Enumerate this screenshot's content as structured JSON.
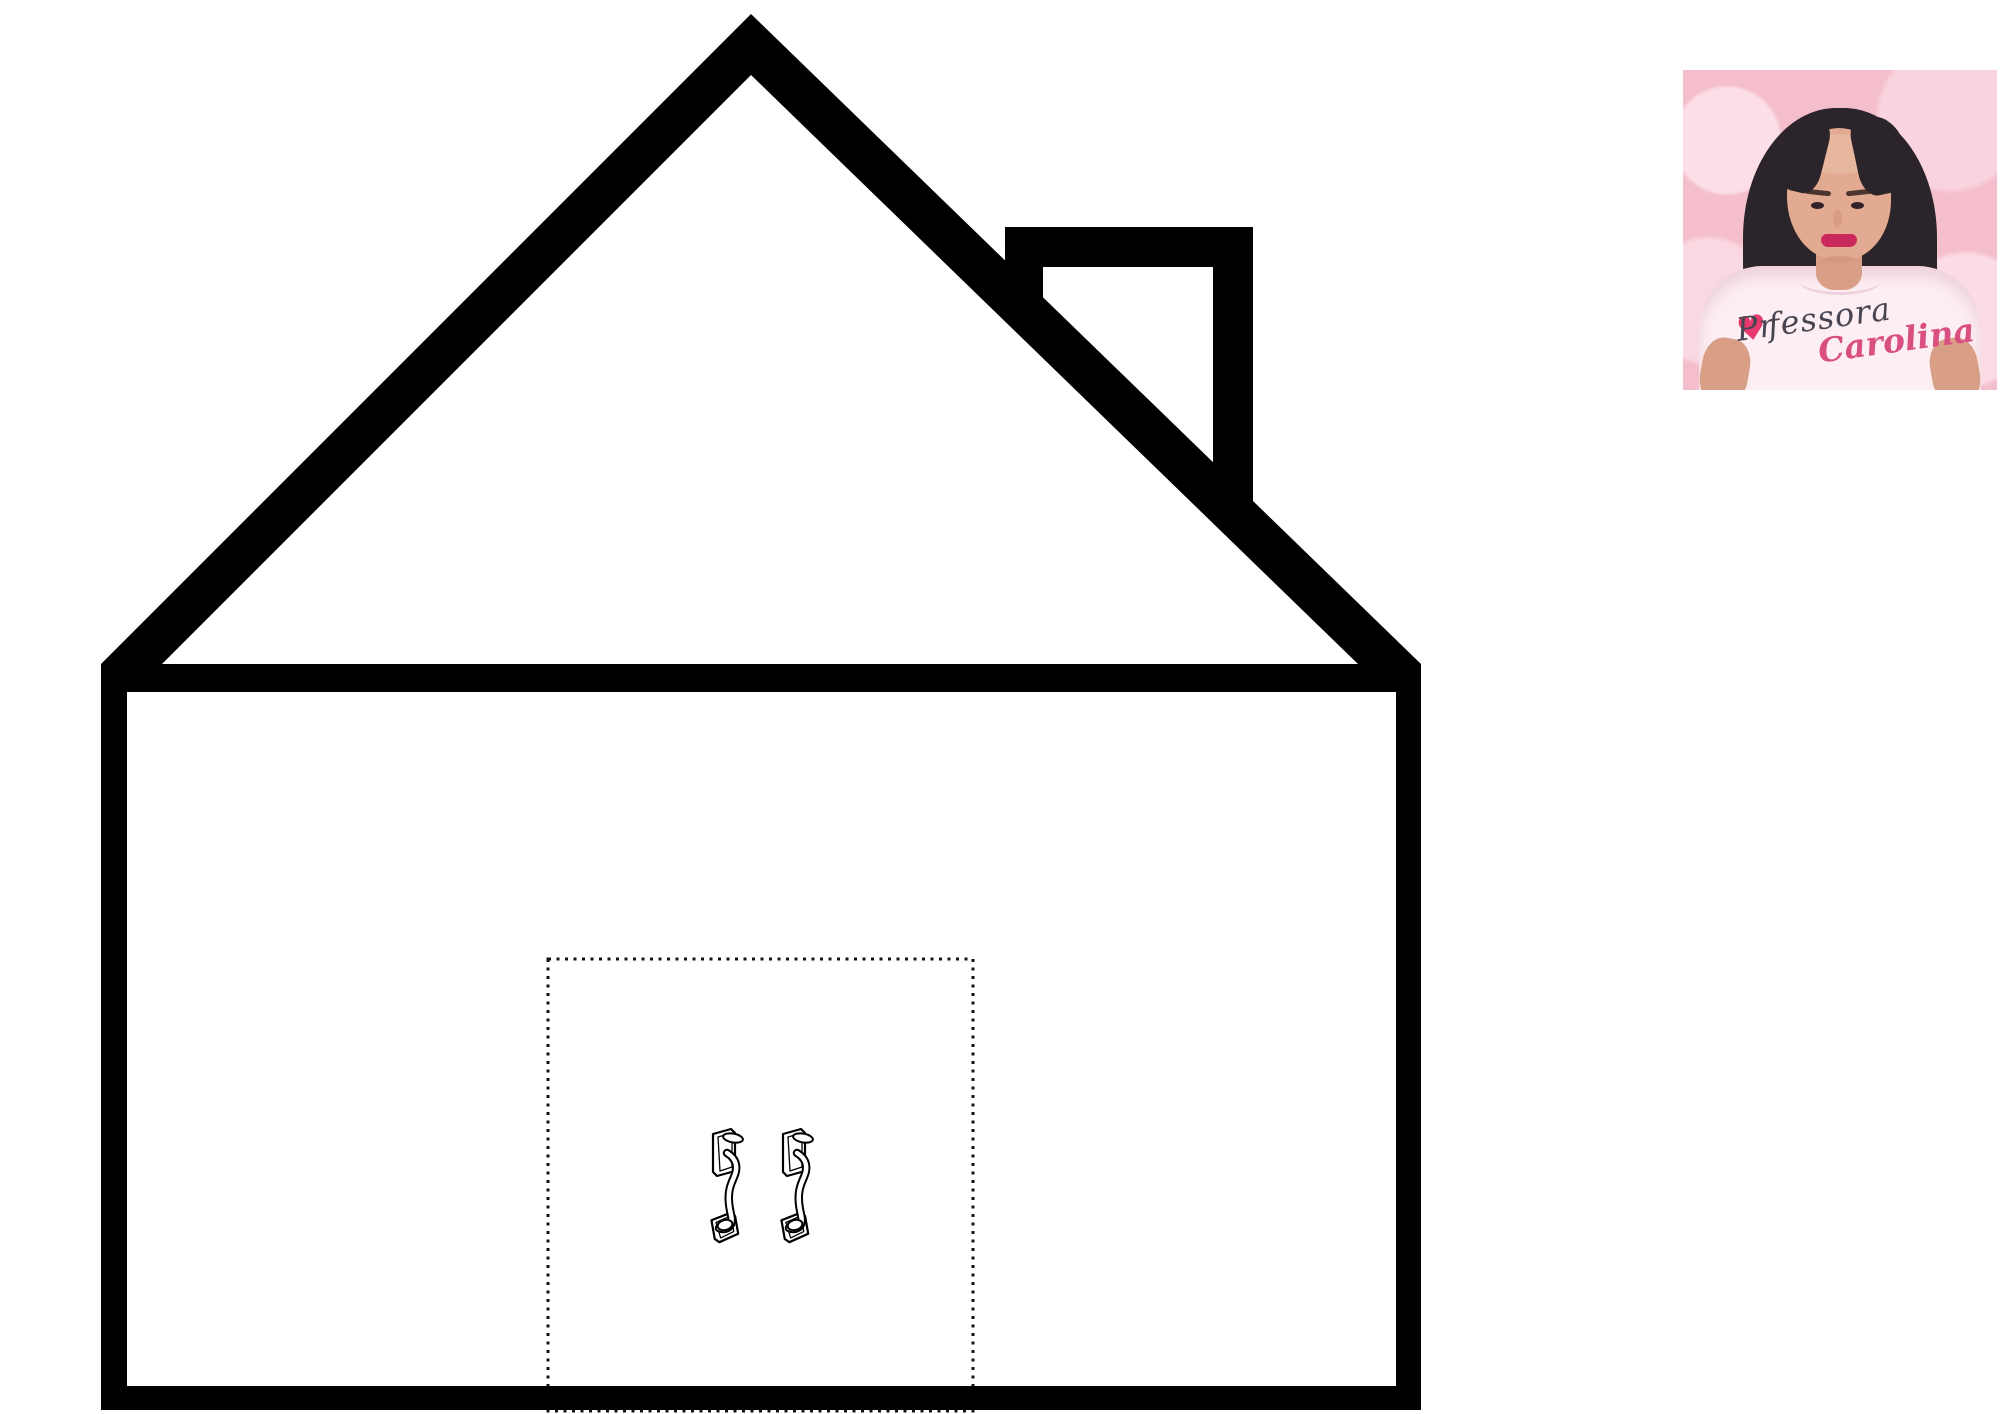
{
  "canvas": {
    "width": 2000,
    "height": 1414,
    "background": "#ffffff"
  },
  "house": {
    "line_color": "#000000",
    "fill_color": "#ffffff"
  },
  "door": {
    "outline_style": "dotted",
    "outline_color": "#111111",
    "handle_icon": "door-handle-icon",
    "handle_count": 2
  },
  "teacher": {
    "title_pre": "Pr",
    "title_heart": "♥",
    "title_post": "fessora",
    "name": "Carolina",
    "photo_bg": "#f5becd",
    "shirt_color": "#fceef2",
    "title_color": "#474552",
    "name_color": "#d94f82",
    "heart_color": "#e8396f"
  }
}
